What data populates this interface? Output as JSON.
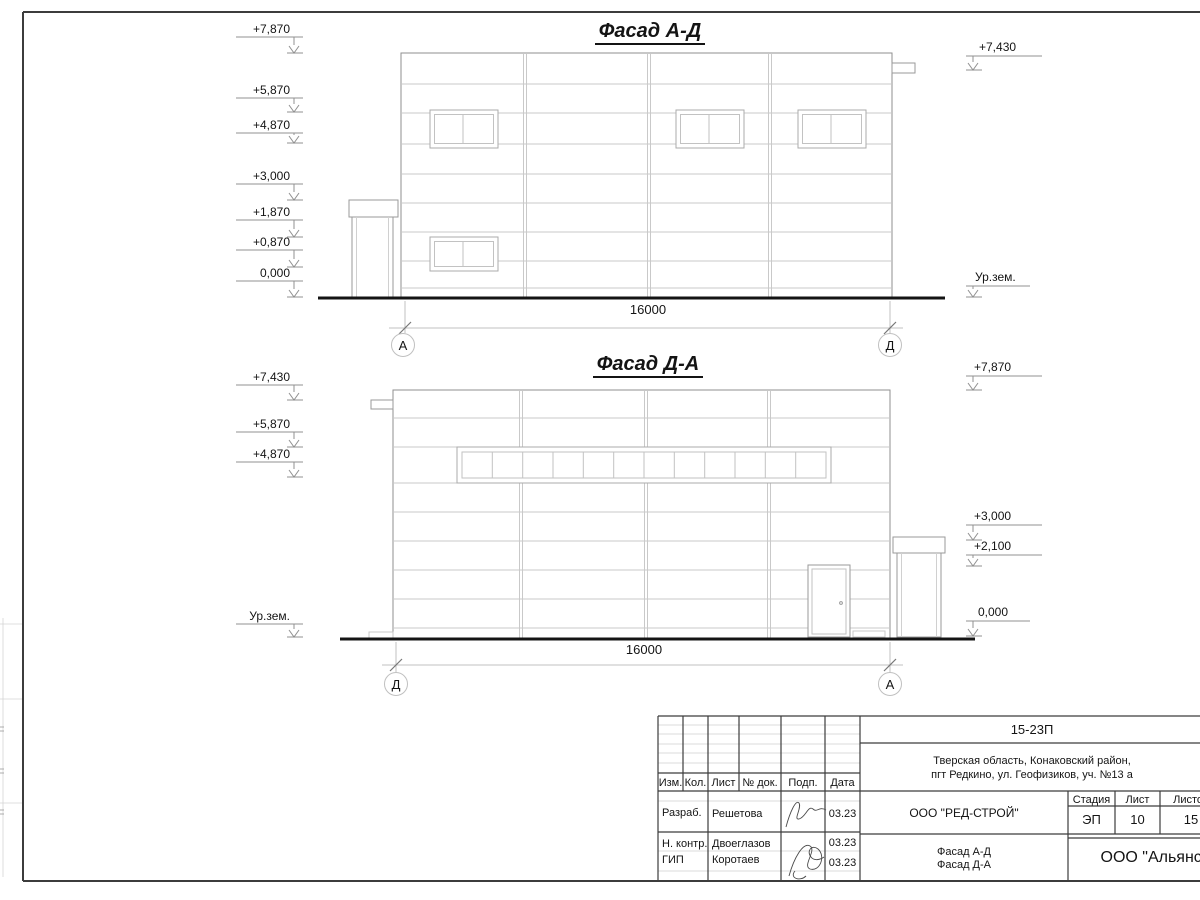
{
  "facade_top": {
    "title": "Фасад А-Д",
    "dimension": "16000",
    "axis_left": "А",
    "axis_right": "Д",
    "marks_left": [
      "+7,870",
      "+5,870",
      "+4,870",
      "+3,000",
      "+1,870",
      "+0,870",
      "0,000"
    ],
    "mark_right_top": "+7,430",
    "ground_label": "Ур.зем."
  },
  "facade_bottom": {
    "title": "Фасад Д-А",
    "dimension": "16000",
    "axis_left": "Д",
    "axis_right": "А",
    "marks_left": [
      "+7,430",
      "+5,870",
      "+4,870"
    ],
    "ground_label_left": "Ур.зем.",
    "marks_right": [
      "+7,870",
      "+3,000",
      "+2,100",
      "0,000"
    ]
  },
  "title_block": {
    "doc_number": "15-23П",
    "address_line1": "Тверская область, Конаковский район,",
    "address_line2": "пгт Редкино, ул. Геофизиков, уч. №13 а",
    "columns": {
      "izm": "Изм.",
      "kol": "Кол.",
      "list": "Лист",
      "doc": "№ док.",
      "podp": "Подп.",
      "data": "Дата"
    },
    "rows": [
      {
        "role": "Разраб.",
        "name": "Решетова",
        "date": "03.23"
      },
      {
        "role": "Н. контр.",
        "name": "Двоеглазов",
        "date": "03.23"
      },
      {
        "role": "ГИП",
        "name": "Коротаев",
        "date": "03.23"
      }
    ],
    "company": "ООО \"РЕД-СТРОЙ\"",
    "stage_label": "Стадия",
    "sheet_label": "Лист",
    "sheets_label": "Листов",
    "stage": "ЭП",
    "sheet_no": "10",
    "sheets_total": "15",
    "drawing_title_line1": "Фасад А-Д",
    "drawing_title_line2": "Фасад Д-А",
    "org": "ООО \"Альянс\""
  }
}
